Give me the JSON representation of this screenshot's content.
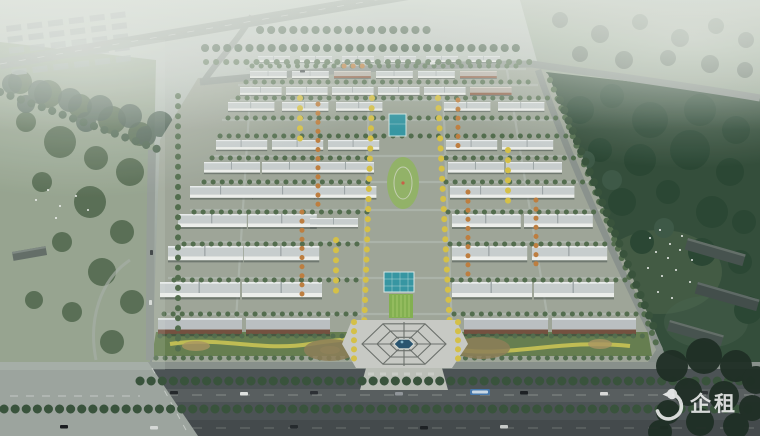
{
  "watermark": {
    "logo": "penguin-logo",
    "text": "企租",
    "color": "#ffffff"
  },
  "palette": {
    "estate_ground": "#9ba395",
    "fields_green": "#93a38f",
    "meadow_green": "#87977f",
    "park_green": "#2c4733",
    "tree_green": "#4c6847",
    "tree_dark": "#314c34",
    "tree_yellow": "#d4bf41",
    "tree_orange": "#bc7a38",
    "building_roof": "#c7cdcd",
    "building_wall": "#eef0ec",
    "building_brick": "#8d5a40",
    "building_rust": "#6f4a38",
    "road_gray": "#868f89",
    "boulevard_dark": "#454c4e",
    "intersection_gray": "#99a29b",
    "plaza_paving": "#c7c9c3",
    "pool_teal": "#2f93a0",
    "lawn_green": "#7fae4a",
    "pond_blue": "#214e6b",
    "berm_green": "#5d7845",
    "berm_yellow": "#c9c24e"
  }
}
